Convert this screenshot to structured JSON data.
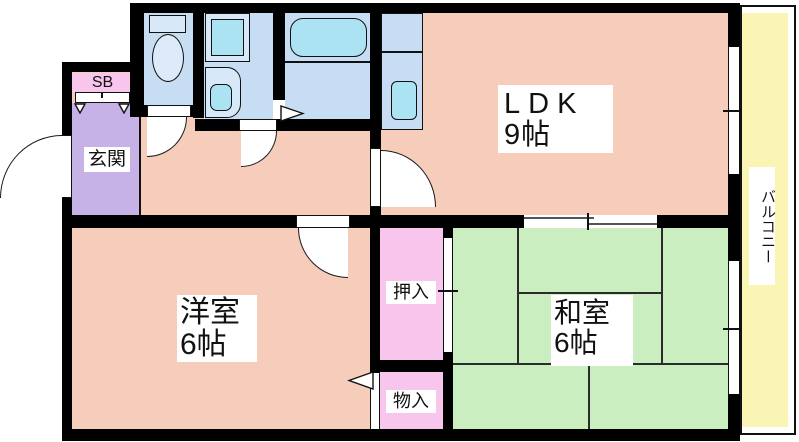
{
  "meta": {
    "type": "apartment-floorplan"
  },
  "rooms": {
    "ldk": {
      "name": "LDK",
      "size": "9帖"
    },
    "western_room": {
      "name": "洋室",
      "size": "6帖"
    },
    "japanese_room": {
      "name": "和室",
      "size": "6帖"
    },
    "entrance": {
      "name": "玄関"
    },
    "shoe_box": {
      "name": "SB"
    },
    "closet": {
      "name": "押入"
    },
    "storage": {
      "name": "物入"
    },
    "balcony": {
      "name": "バルコニー"
    }
  },
  "colors": {
    "room_pink": "#F6CCBB",
    "tatami_green": "#CBEEC1",
    "balcony_yellow": "#FAF5B5",
    "entrance_purple": "#C7B2E8",
    "closet_pink": "#F8C6EC",
    "wet_area_blue": "#C7DDF3",
    "fixture_cyan": "#ABE3F3",
    "fixture_light": "#D7E8F8",
    "toilet_white": "#DCEAF9",
    "wall_black": "#000000"
  }
}
